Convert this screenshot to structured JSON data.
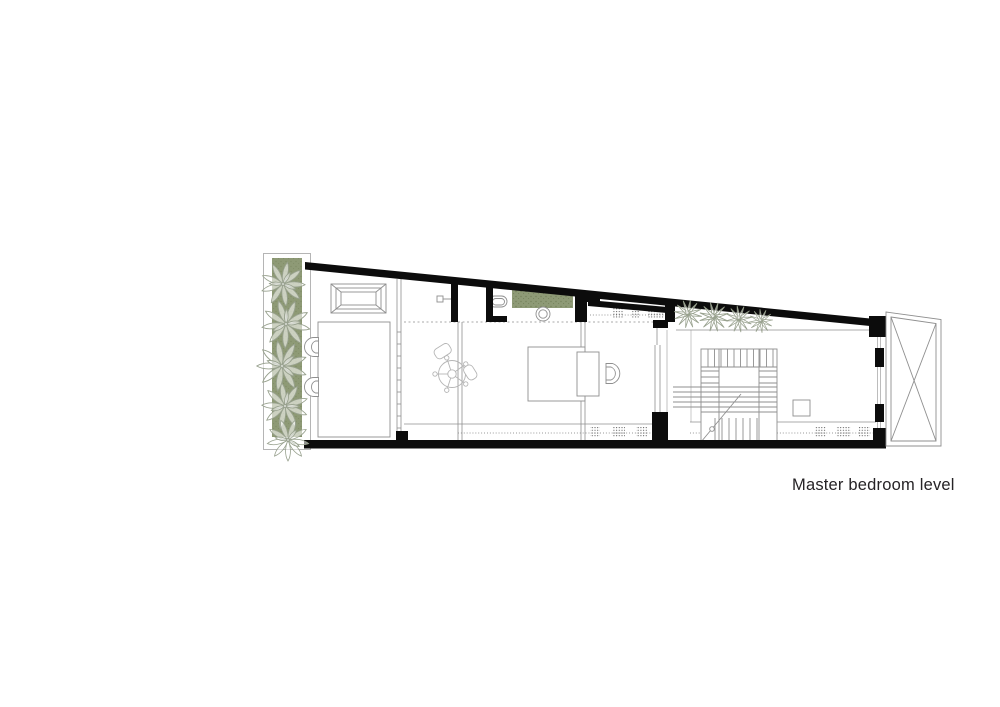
{
  "caption": {
    "text": "Master bedroom level"
  },
  "colors": {
    "background": "#ffffff",
    "wall": "#0c0c0c",
    "line": "#8f8f8f",
    "line_light": "#b5b5b5",
    "planter_green": "#8e9a76",
    "planter_speckle": "#6f7d55",
    "plant_stroke": "#98a18e",
    "vent_dot": "#555555"
  }
}
